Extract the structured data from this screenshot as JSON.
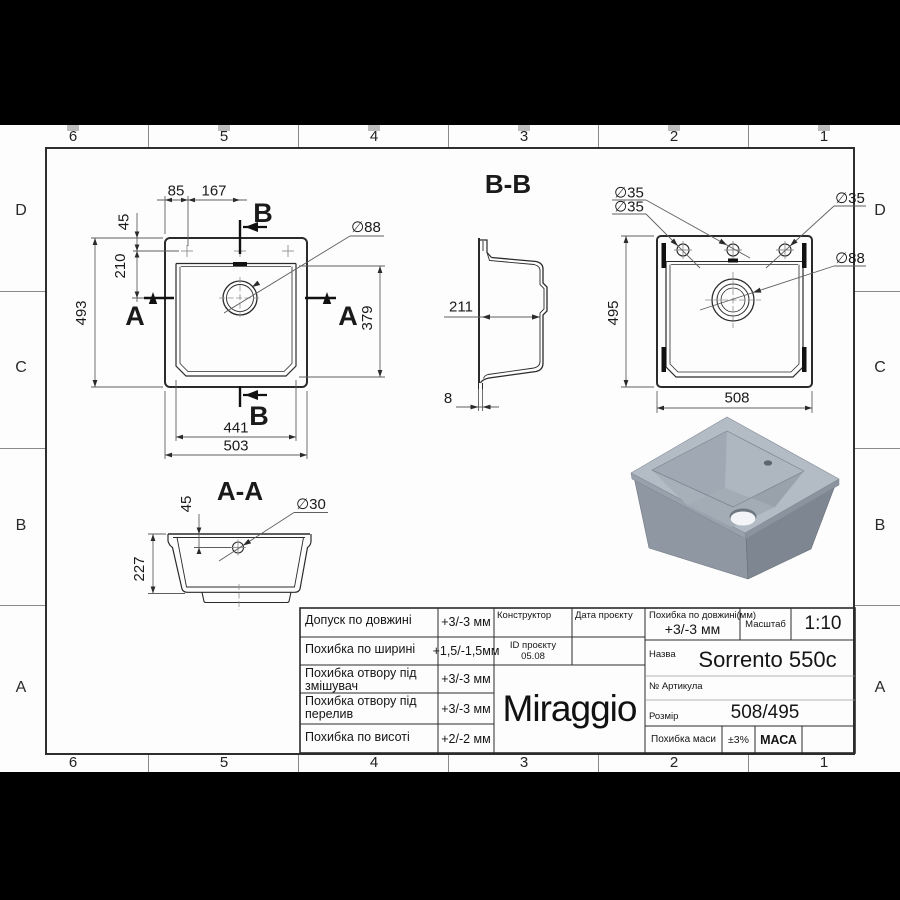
{
  "zones": {
    "columns": [
      "6",
      "5",
      "4",
      "3",
      "2",
      "1"
    ],
    "rows": [
      "D",
      "C",
      "B",
      "A"
    ]
  },
  "views": {
    "plan": {
      "dim_85": "85",
      "dim_167": "167",
      "dim_45": "45",
      "dim_210": "210",
      "dim_493": "493",
      "dim_379": "379",
      "dim_441": "441",
      "dim_503": "503",
      "dia_88": "∅88",
      "section_b": "B",
      "section_a": "A"
    },
    "section_bb": {
      "title": "B-B",
      "dim_211": "211",
      "dim_8": "8"
    },
    "bottom": {
      "dim_495": "495",
      "dim_508": "508",
      "dia_35_a": "∅35",
      "dia_35_b": "∅35",
      "dia_35_c": "∅35",
      "dia_88": "∅88"
    },
    "section_aa": {
      "title": "A-A",
      "dim_45": "45",
      "dim_227": "227",
      "dia_30": "∅30"
    }
  },
  "title_block": {
    "tolerances": [
      {
        "label": "Допуск по довжині",
        "value": "+3/-3 мм"
      },
      {
        "label": "Похибка по ширині",
        "value": "+1,5/-1,5мм"
      },
      {
        "label": "Похибка отвору під змішувач",
        "value": "+3/-3 мм"
      },
      {
        "label": "Похибка отвору під перелив",
        "value": "+3/-3 мм"
      },
      {
        "label": "Похибка по висоті",
        "value": "+2/-2 мм"
      }
    ],
    "constructor_label": "Конструктор",
    "project_date_label": "Дата проєкту",
    "project_id_label": "ID проєкту",
    "project_id_value": "05.08",
    "logo": "Miraggio",
    "length_tolerance_label": "Похибка по довжині(мм)",
    "length_tolerance_value": "+3/-3 мм",
    "scale_label": "Масштаб",
    "scale_value": "1:10",
    "name_label": "Назва",
    "name_value": "Sorrento 550c",
    "article_label": "№ Артикула",
    "size_label": "Розмір",
    "size_value": "508/495",
    "mass_tolerance_label": "Похибка маси",
    "mass_tolerance_value": "±3%",
    "mass_label": "МАСА"
  }
}
